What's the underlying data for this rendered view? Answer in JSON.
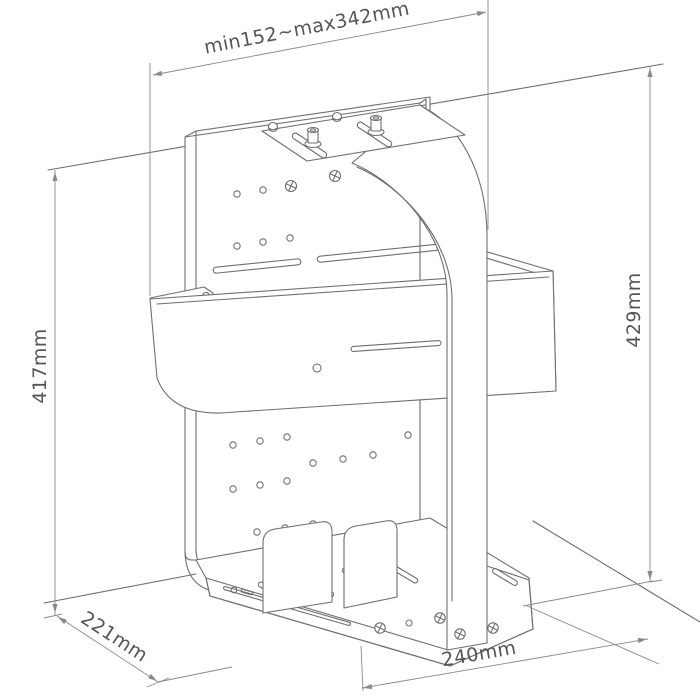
{
  "page": {
    "background": "#ffffff",
    "content": "isometric technical line drawing of a wall-mounted holder bracket with dimension annotations"
  },
  "drawing": {
    "line_color": "#6f6f6f",
    "dimension_line_color": "#8a8a8a",
    "text_color": "#555555",
    "dimensions": {
      "top_width": "min152~max342mm",
      "left_height": "417mm",
      "right_height": "429mm",
      "floor_depth": "221mm",
      "base_width": "240mm"
    }
  }
}
